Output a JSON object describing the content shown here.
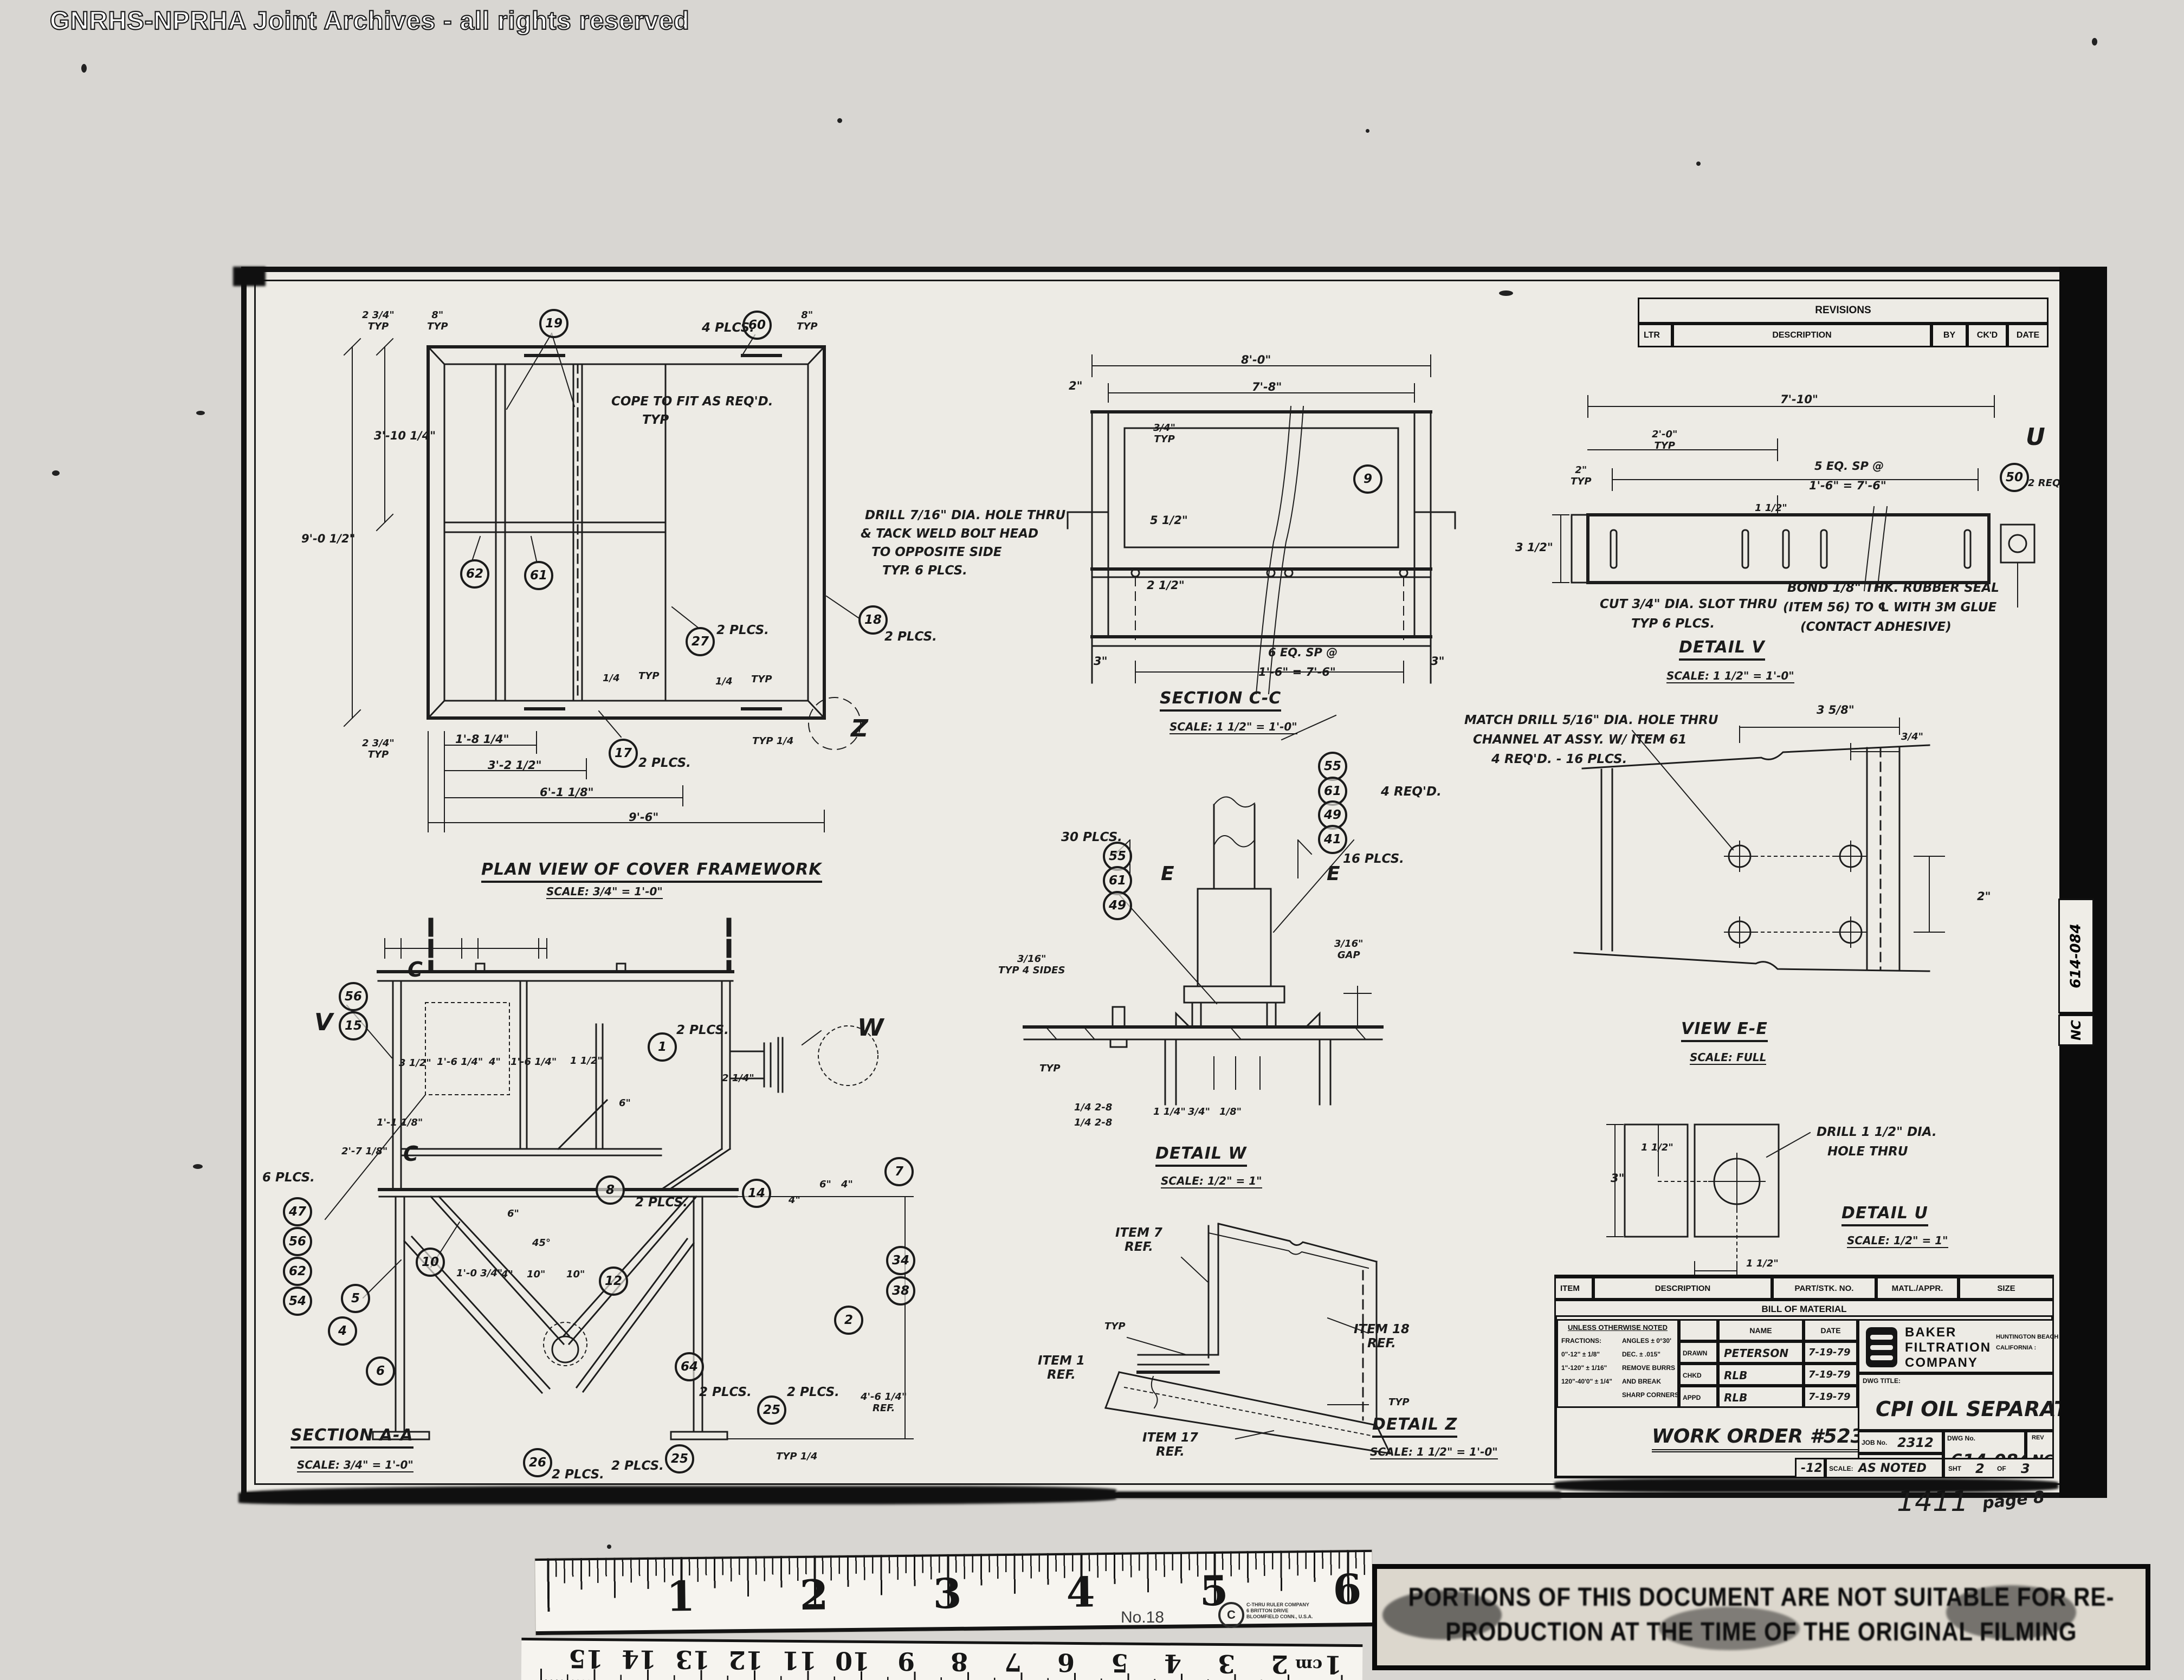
{
  "wm": "GNRHS-NPRHA Joint Archives - all rights reserved",
  "rev": {
    "title": "REVISIONS",
    "ltr": "LTR",
    "desc": "DESCRIPTION",
    "by": "BY",
    "ckd": "CK'D",
    "date": "DATE"
  },
  "band": {
    "dwg": "614-084",
    "rev": "NC"
  },
  "c": {
    "typ": "TYP",
    "p2": "2 PLCS.",
    "p4": "4 PLCS.",
    "p6": "6 PLCS.",
    "p16": "16 PLCS.",
    "p30": "30 PLCS.",
    "r4": "4 REQ'D.",
    "w14": "1/4",
    "t14": "TYP 1/4",
    "w28": "1/4  2-8"
  },
  "b": {
    "n1": "1",
    "n2": "2",
    "n4": "4",
    "n5": "5",
    "n6": "6",
    "n7": "7",
    "n8": "8",
    "n9": "9",
    "n10": "10",
    "n12": "12",
    "n14": "14",
    "n15": "15",
    "n17": "17",
    "n18": "18",
    "n19": "19",
    "n25": "25",
    "n26": "26",
    "n27": "27",
    "n34": "34",
    "n38": "38",
    "n41": "41",
    "n47": "47",
    "n49": "49",
    "n50": "50",
    "n54": "54",
    "n55": "55",
    "n56": "56",
    "n60": "60",
    "n61": "61",
    "n62": "62",
    "n64": "64"
  },
  "plan": {
    "cap": "PLAN VIEW OF COVER FRAMEWORK",
    "scale": "SCALE: 3/4\" = 1'-0\"",
    "cope1": "COPE TO FIT AS REQ'D.",
    "cope2": "TYP",
    "d234": "2 3/4\"",
    "d8": "8\"",
    "d31014": "3'-10 1/4\"",
    "d9012": "9'-0 1/2\"",
    "d1814": "1'-8 1/4\"",
    "d3212": "3'-2 1/2\"",
    "d6118": "6'-1 1/8\"",
    "d96": "9'-6\"",
    "z": "Z"
  },
  "scc": {
    "cap": "SECTION C-C",
    "scale": "SCALE: 1 1/2\" = 1'-0\"",
    "d80": "8'-0\"",
    "d78": "7'-8\"",
    "d2": "2\"",
    "d34": "3/4\"",
    "d512": "5 1/2\"",
    "d212": "2 1/2\"",
    "d3": "3\"",
    "sp1": "6 EQ. SP @",
    "sp2": "1'-6\" = 7'-6\"",
    "n1": "DRILL 7/16\" DIA. HOLE THRU",
    "n2": "& TACK WELD BOLT HEAD",
    "n3": "TO OPPOSITE SIDE",
    "n4": "TYP. 6 PLCS."
  },
  "dv": {
    "cap": "DETAIL V",
    "scale": "SCALE: 1 1/2\" = 1'-0\"",
    "d710": "7'-10\"",
    "d20": "2'-0\"",
    "d2": "2\"",
    "sp1": "5 EQ. SP @",
    "sp2": "1'-6\" = 7'-6\"",
    "d312": "3 1/2\"",
    "d112": "1 1/2\"",
    "u": "U",
    "r2": "2 REQ'D.",
    "cut1": "CUT 3/4\" DIA. SLOT THRU",
    "cut2": "TYP 6 PLCS.",
    "bond1": "BOND 1/8\" THK. RUBBER SEAL",
    "bond2": "(ITEM 56) TO ℄ WITH 3M GLUE",
    "bond3": "(CONTACT ADHESIVE)"
  },
  "ee": {
    "cap": "VIEW E-E",
    "scale": "SCALE: FULL",
    "n1": "MATCH DRILL 5/16\" DIA. HOLE THRU",
    "n2": "CHANNEL AT ASSY. W/ ITEM 61",
    "n3": "4 REQ'D. - 16 PLCS.",
    "d358": "3 5/8\"",
    "d34": "3/4\"",
    "d2": "2\""
  },
  "dw": {
    "cap": "DETAIL W",
    "scale": "SCALE: 1/2\" = 1\"",
    "d316": "3/16\"",
    "s4": "TYP 4 SIDES",
    "gap": "GAP",
    "d114": "1 1/4\"",
    "d34": "3/4\"",
    "d18": "1/8\"",
    "e": "E"
  },
  "du": {
    "cap": "DETAIL U",
    "scale": "SCALE: 1/2\" = 1\"",
    "n1": "DRILL 1 1/2\" DIA.",
    "n2": "HOLE THRU",
    "d112": "1 1/2\"",
    "d3": "3\""
  },
  "saa": {
    "cap": "SECTION A-A",
    "scale": "SCALE: 3/4\" = 1'-0\"",
    "v": "V",
    "w": "W",
    "cmk": "C",
    "d312": "3 1/2\"",
    "d1614": "1'-6 1/4\"",
    "d4": "4\"",
    "d112": "1 1/2\"",
    "d214": "2 1/4\"",
    "d6": "6\"",
    "d2718": "2'-7 1/8\"",
    "d1118": "1'-1 1/8\"",
    "d1034": "1'-0 3/4\"",
    "d10": "10\"",
    "d45": "45°",
    "d4614": "4'-6 1/4\"",
    "ref": "REF."
  },
  "dz": {
    "cap": "DETAIL Z",
    "scale": "SCALE: 1 1/2\" = 1'-0\"",
    "i7": "ITEM 7",
    "i1": "ITEM 1",
    "i18": "ITEM 18",
    "i17": "ITEM 17",
    "ref": "REF."
  },
  "tb": {
    "h_item": "ITEM",
    "h_desc": "DESCRIPTION",
    "h_part": "PART/STK. NO.",
    "h_matl": "MATL./APPR.",
    "h_size": "SIZE",
    "bom": "BILL OF MATERIAL",
    "uon": "UNLESS OTHERWISE NOTED",
    "tol1": "FRACTIONS:",
    "tol2": "0\"-12\"    ± 1/8\"",
    "tol3": "1\"-120\"   ± 1/16\"",
    "tol4": "120\"-40'0\" ± 1/4\"",
    "tolr1": "ANGLES ± 0°30'",
    "tolr2": "DEC.  ± .015\"",
    "tolr3": "REMOVE BURRS",
    "tolr4": "AND BREAK",
    "tolr5": "SHARP CORNERS",
    "name": "NAME",
    "date": "DATE",
    "drawn": "DRAWN",
    "chkd": "CHKD",
    "appd": "APPD",
    "drawn_v": "PETERSON",
    "chkd_v": "RLB",
    "appd_v": "RLB",
    "d1": "7-19-79",
    "d2": "7-19-79",
    "d3": "7-19-79",
    "co1": "BAKER",
    "co2": "FILTRATION",
    "co3": "COMPANY",
    "loc1": "HUNTINGTON BEACH",
    "loc2": "CALIFORNIA :",
    "dwgtitle_l": "DWG TITLE:",
    "title": "CPI  OIL  SEPARATOR",
    "wo": "WORK ORDER #5232",
    "job_l": "JOB No.",
    "job_v": "2312",
    "dept": "DEPT.",
    "dwg_l": "DWG No.",
    "dwg_v": "614-084",
    "rev_l": "REV",
    "rev_v": "NC",
    "scale_l": "SCALE:",
    "scale_v": "AS NOTED",
    "sht_l": "SHT",
    "sht_v": "2",
    "of_l": "OF",
    "of_v": "3",
    "hw_dash": "-12",
    "hw_1411": "1411",
    "hw_page": "page 8"
  },
  "ruler": {
    "in": [
      "1",
      "2",
      "3",
      "4",
      "5",
      "6"
    ],
    "no18": "No.18",
    "co1": "C-THRU RULER COMPANY",
    "co2": "6 BRITTON DRIVE",
    "co3": "BLOOMFIELD CONN., U.S.A.",
    "cm": [
      "15",
      "14",
      "13",
      "12",
      "11",
      "10",
      "9",
      "8",
      "7",
      "6",
      "5",
      "4",
      "3",
      "2",
      "1"
    ],
    "cml": "cm"
  },
  "stamp": {
    "l1": "PORTIONS OF THIS DOCUMENT ARE NOT SUITABLE FOR RE-",
    "l2": "PRODUCTION AT THE TIME OF THE ORIGINAL FILMING"
  }
}
